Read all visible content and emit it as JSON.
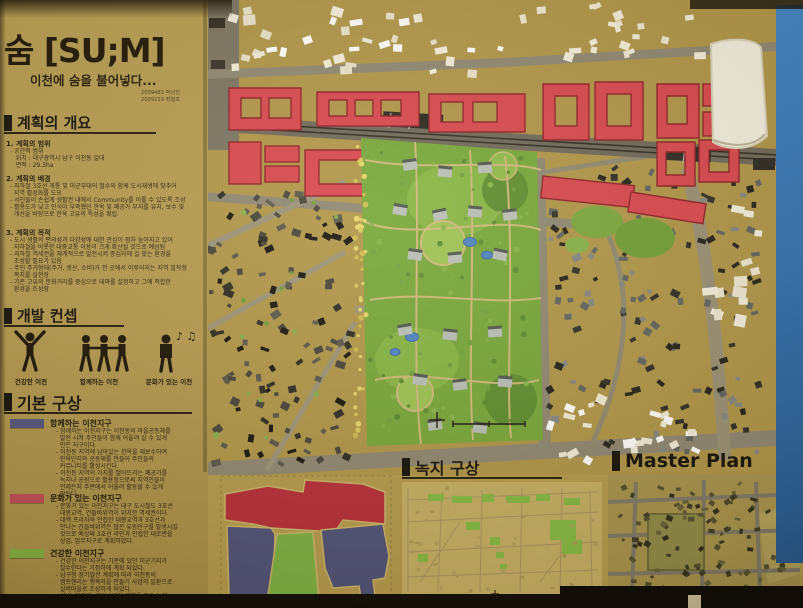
{
  "header": {
    "title": "숨 [SU;M]",
    "subtitle": "이천에 숨을 불어넣다...",
    "credit1": "2009483 박남진",
    "credit2": "2009219 최형조"
  },
  "overview": {
    "title": "계획의 개요",
    "s1_title": "1. 계획의 범위",
    "s1_body": "- 공간적 범위\n   위치 : 대구광역시 남구 이천동 일대\n   면적 : 29.3ha",
    "s2_title": "2. 계획의 배경",
    "s2_body": "- 지하철 3호선 개통 및 미군부대의 철수와 함께 도시재생에 맞추어\n  지역 활성화를 도모\n- 서민들이 손쉽게 생활권 내에서 Community를 이룰 수 있도록 조성\n- 활용도가 낮고 인식이 부족했던 한옥 및 폐공가 부지를 유지, 보수 및\n  개선을 바탕으로 한옥 고유의 특성을 확립",
    "s3_title": "3. 계획의 목적",
    "s3_body": "- 도시 생활의 편의성과 다양성에 대한 관심이 점차 높아지고 있어\n  지하철을 비롯한 대중교통 이용이 크게 확산될 것으로 예상됨\n- 지하철 역세권을 체계적으로 발전시켜 중심지에 걸 맞는 환경을\n  조성할 필요가 있음\n- 주민 주거형태(주거, 생산, 소비)가 한 곳에서 이루어지는 지역 밀착형\n  복지를 실현함\n- 기존 고유의 문화거리를 중심으로 테마를 설정하고 그에 적합한\n  환경을 조성함"
  },
  "concept": {
    "title": "개발 컨셉",
    "items": [
      {
        "label": "건강한 이천"
      },
      {
        "label": "함께하는 이천"
      },
      {
        "label": "문화가 있는 이천"
      }
    ],
    "music_notes": "♪ ♫"
  },
  "basic_plan": {
    "title": "기본 구상",
    "legend": [
      {
        "color": "#51547e",
        "name": "함께하는 이천지구",
        "body": "- 함께하는 이천지구는 이천동의 마을공동체를\n  발전 시켜 주민들이 함께 어울려 살 수 있게\n  만든 지구이다.\n- 이천동 지역에 남아있는 한옥을 재보수하여\n  한옥단지와 공동체를 만들어 주민들의\n  커뮤니티를 활성시킨다.\n- 이천동 지역의 가치를 떨어뜨리는 폐공가를\n  녹지나 공원으로 활용함으로써 지역민들이\n  언제든지 주변에서 어울려 활동할 수 있게\n  만든다."
      },
      {
        "color": "#bf4a55",
        "name": "문화가 있는 이천지구",
        "body": "- 문화가 있는 이천지구는 대구 도시철도 3호선\n  대봉교역, 건들바위역이 위치한 역세권이다.\n- 대백 프라자와 인접한 대봉교역과 3호선과\n  만나는 건들바위역은 많은 유동인구를 발생시킬\n  것으로 예상돼 3호선 라인과 인접한 대로변을\n  상업, 업무지구로 계획하였다."
      },
      {
        "color": "#7fae3f",
        "name": "건강한 이천지구",
        "body": "- 건강한 이천지구는 기존에 있던 미군기지가\n  철수한다는 가정하에 계획 되었다.\n- 남구청 장기발전 계획에 따라 이천동의\n  캠프헨리는 행복마을 만들기 사업의 일환으로\n  실버마을로 조성하게 되었다.\n- 실버, 빌리지, 캐어 3가지 영역을 묶은 노인\n  주도형 실버 빌리지를 조성하여 건강한 노년\n  생활을 보낼 수 있는 단지로 계획하였다."
      }
    ]
  },
  "green_plan": {
    "title": "녹지 구상"
  },
  "master_plan": {
    "title": "Master Plan"
  }
}
